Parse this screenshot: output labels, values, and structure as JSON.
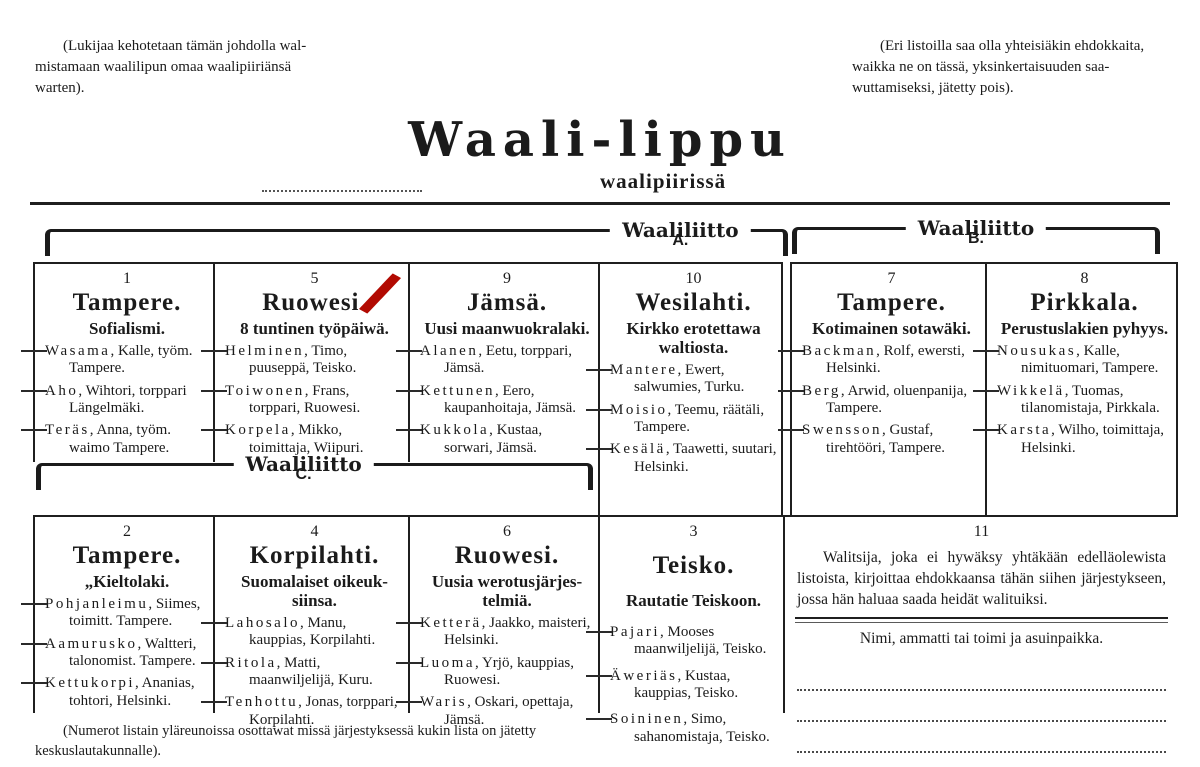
{
  "page": {
    "note_top_left": "(Lukijaa kehotetaan tämän johdolla wal-\nmistamaan waalilipun omaa waalipiiriänsä\nwarten).",
    "note_top_right": "(Eri listoilla saa olla yhteisiäkin ehdokkaita,\nwaikka ne on tässä, yksinkertaisuuden saa-\nwuttamiseksi, jätetty pois).",
    "title": "Waali-lippu",
    "subtitle": "waalipiirissä",
    "bottom_note": "(Numerot listain yläreunoissa osottawat missä järjestyksessä kukin lista on jätetty\nkeskuslautakunnalle)."
  },
  "coalitions": {
    "label": "Waaliliitto",
    "a_letter": "A.",
    "b_letter": "B.",
    "c_letter": "C."
  },
  "check_mark": {
    "marked_list_number": "5",
    "color": "#b20a02"
  },
  "lists": [
    {
      "number": "1",
      "coalition": "A",
      "place": "Tampere.",
      "slogan": "Sofialismi.",
      "candidates": [
        {
          "surname": "Wasama",
          "details": "Kalle, työm. Tampere."
        },
        {
          "surname": "Aho",
          "details": "Wihtori, torppari Längelmäki."
        },
        {
          "surname": "Teräs",
          "details": "Anna, työm. waimo Tampere."
        }
      ]
    },
    {
      "number": "5",
      "coalition": "A",
      "place": "Ruowesi.",
      "slogan": "8 tuntinen työpäiwä.",
      "check_marked": true,
      "candidates": [
        {
          "surname": "Helminen",
          "details": "Timo, puuseppä, Teisko."
        },
        {
          "surname": "Toiwonen",
          "details": "Frans, torppari, Ruowesi."
        },
        {
          "surname": "Korpela",
          "details": "Mikko, toimittaja, Wiipuri."
        }
      ]
    },
    {
      "number": "9",
      "coalition": "A",
      "place": "Jämsä.",
      "slogan": "Uusi maanwuokralaki.",
      "candidates": [
        {
          "surname": "Alanen",
          "details": "Eetu, torppari, Jämsä."
        },
        {
          "surname": "Kettunen",
          "details": "Eero, kaupanhoitaja, Jämsä."
        },
        {
          "surname": "Kukkola",
          "details": "Kustaa, sorwari, Jämsä."
        }
      ]
    },
    {
      "number": "10",
      "coalition": "A",
      "place": "Wesilahti.",
      "slogan": "Kirkko erotettawa\nwaltiosta.",
      "candidates": [
        {
          "surname": "Mantere",
          "details": "Ewert, salwumies, Turku."
        },
        {
          "surname": "Moisio",
          "details": "Teemu, räätäli, Tampere."
        },
        {
          "surname": "Kesälä",
          "details": "Taawetti, suutari, Helsinki."
        }
      ]
    },
    {
      "number": "7",
      "coalition": "B",
      "place": "Tampere.",
      "slogan": "Kotimainen sotawäki.",
      "candidates": [
        {
          "surname": "Backman",
          "details": "Rolf, ewersti, Helsinki."
        },
        {
          "surname": "Berg",
          "details": "Arwid, oluenpanija, Tampere."
        },
        {
          "surname": "Swensson",
          "details": "Gustaf, tirehtööri, Tampere."
        }
      ]
    },
    {
      "number": "8",
      "coalition": "B",
      "place": "Pirkkala.",
      "slogan": "Perustuslakien pyhyys.",
      "candidates": [
        {
          "surname": "Nousukas",
          "details": "Kalle, nimituomari, Tampere."
        },
        {
          "surname": "Wikkelä",
          "details": "Tuomas, tilanomistaja, Pirkkala."
        },
        {
          "surname": "Karsta",
          "details": "Wilho, toimittaja, Helsinki."
        }
      ]
    },
    {
      "number": "2",
      "coalition": "C",
      "place": "Tampere.",
      "slogan": "„Kieltolaki.",
      "candidates": [
        {
          "surname": "Pohjanleimu",
          "details": "Siimes, toimitt. Tampere."
        },
        {
          "surname": "Aamurusko",
          "details": "Waltteri, talonomist. Tampere."
        },
        {
          "surname": "Kettukorpi",
          "details": "Ananias, tohtori, Helsinki."
        }
      ]
    },
    {
      "number": "4",
      "coalition": "C",
      "place": "Korpilahti.",
      "slogan": "Suomalaiset oikeuk-\nsiinsa.",
      "candidates": [
        {
          "surname": "Lahosalo",
          "details": "Manu, kauppias, Korpilahti."
        },
        {
          "surname": "Ritola",
          "details": "Matti, maanwiljelijä, Kuru."
        },
        {
          "surname": "Tenhottu",
          "details": "Jonas, torppari, Korpilahti."
        }
      ]
    },
    {
      "number": "6",
      "coalition": "C",
      "place": "Ruowesi.",
      "slogan": "Uusia werotusjärjes-\ntelmiä.",
      "candidates": [
        {
          "surname": "Ketterä",
          "details": "Jaakko, maisteri, Helsinki."
        },
        {
          "surname": "Luoma",
          "details": "Yrjö, kauppias, Ruowesi."
        },
        {
          "surname": "Waris",
          "details": "Oskari, opettaja, Jämsä."
        }
      ]
    },
    {
      "number": "3",
      "coalition": "",
      "place": "Teisko.",
      "slogan": "Rautatie Teiskoon.",
      "candidates": [
        {
          "surname": "Pajari",
          "details": "Mooses maanwiljelijä, Teisko."
        },
        {
          "surname": "Äweriäs",
          "details": "Kustaa, kauppias, Teisko."
        },
        {
          "surname": "Soininen",
          "details": "Simo, sahanomistaja, Teisko."
        }
      ]
    }
  ],
  "write_in": {
    "number": "11",
    "instructions": "Walitsija, joka ei hywäksy yhtäkään edelläolewista listoista, kirjoittaa ehdokkaansa tähän siihen järjestykseen, jossa hän haluaa saada heidät walituiksi.",
    "fields_header": "Nimi, ammatti tai toimi ja asuinpaikka.",
    "blank_lines": 3
  },
  "colors": {
    "ink": "#1b1b1b",
    "paper": "#ffffff",
    "check_mark_red": "#b20a02"
  }
}
